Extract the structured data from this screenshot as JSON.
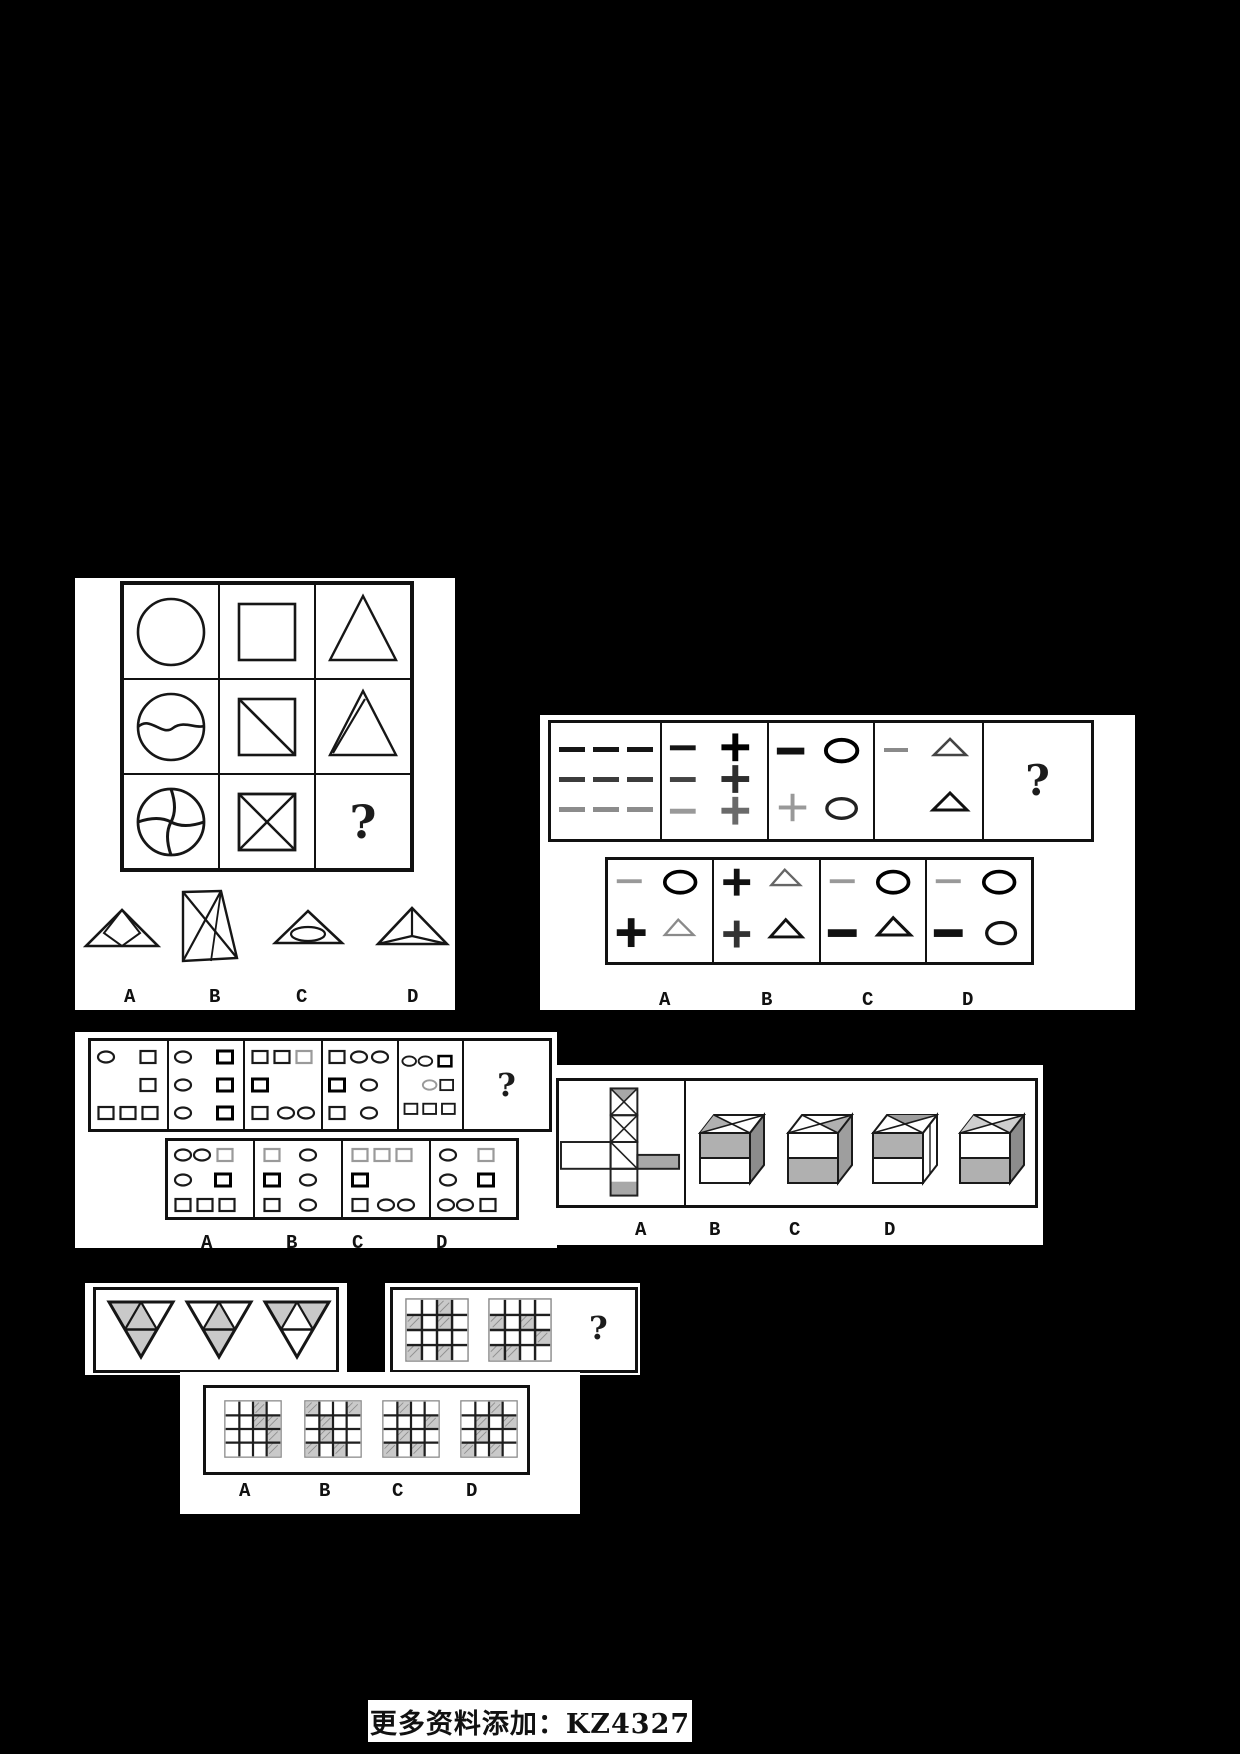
{
  "glyphs": {
    "question_mark": "?"
  },
  "footer": {
    "text": "更多资料添加：KZ4327"
  },
  "puzzle1": {
    "type": "figure-matrix-3x3",
    "matrix": [
      [
        "circle",
        "square",
        "triangle"
      ],
      [
        "circle-with-wave-line",
        "square-with-diagonal",
        "triangle-with-inner-line"
      ],
      [
        "circle-pinwheel",
        "square-with-x",
        "?"
      ]
    ],
    "options": [
      {
        "label": "A",
        "figure": "triangle-with-inscribed-diamond"
      },
      {
        "label": "B",
        "figure": "tall-quadrilateral-with-crossed-diagonals"
      },
      {
        "label": "C",
        "figure": "triangle-with-inscribed-ellipse"
      },
      {
        "label": "D",
        "figure": "triangle-with-apex-lines-pyramid"
      }
    ]
  },
  "puzzle2": {
    "type": "figure-sequence",
    "cells": [
      "nine-dashes-3x3-fading",
      "three-dashes-left-three-plusses-right",
      "dash-oval-top-plus-oval-bottom",
      "dash-triangle-top-triangle-bottom",
      "?"
    ],
    "options": [
      {
        "label": "A",
        "figure": "dash-oval-top-plus-triangle-bottom"
      },
      {
        "label": "B",
        "figure": "plus-triangle-top-plus-triangle-bottom"
      },
      {
        "label": "C",
        "figure": "dash-oval-top-dash-triangle-bottom"
      },
      {
        "label": "D",
        "figure": "dash-oval-top-dash-oval-bottom"
      }
    ]
  },
  "puzzle3": {
    "type": "figure-sequence-small-shapes",
    "cells": [
      "oval-square / square / three-squares",
      "oval-square / oval-square / oval-square",
      "three-squares / square / square-two-ovals",
      "square-two-ovals / square-oval / square-oval",
      "two-ovals-square / oval-square / three-squares",
      "?"
    ],
    "options": [
      {
        "label": "A",
        "figure": "two-ovals-square / oval-square / three-squares"
      },
      {
        "label": "B",
        "figure": "square-oval / square-oval / square-oval"
      },
      {
        "label": "C",
        "figure": "three-squares / square / square-two-ovals"
      },
      {
        "label": "D",
        "figure": "oval-square / oval-square / two-ovals-square"
      }
    ]
  },
  "puzzle4": {
    "type": "cube-net-folding",
    "net": "vertical-strip-of-4-squares-with-x-diagonal-and-gray-faces-plus-side-rectangles",
    "options": [
      {
        "label": "A",
        "figure": "cube-gray-top-front-dark-right"
      },
      {
        "label": "B",
        "figure": "cube-white-top-front-gray-bottom"
      },
      {
        "label": "C",
        "figure": "cube-gray-top-front-white-right"
      },
      {
        "label": "D",
        "figure": "cube-white-top-front-gray-bottom-dark-right"
      }
    ]
  },
  "puzzle5": {
    "type": "shaded-triangles-and-grids",
    "triangles": [
      {
        "shaded": [
          "left",
          "center",
          "bottom"
        ]
      },
      {
        "shaded": [
          "center",
          "bottom"
        ]
      },
      {
        "shaded": [
          "left",
          "right"
        ]
      }
    ],
    "question_grids": [
      {
        "shaded": [
          [
            0,
            2
          ],
          [
            1,
            0
          ],
          [
            1,
            2
          ],
          [
            3,
            0
          ],
          [
            3,
            2
          ]
        ]
      },
      {
        "shaded": [
          [
            1,
            0
          ],
          [
            1,
            2
          ],
          [
            2,
            3
          ],
          [
            3,
            0
          ],
          [
            3,
            1
          ]
        ]
      }
    ],
    "option_grids": [
      {
        "label": "A",
        "shaded": [
          [
            0,
            2
          ],
          [
            1,
            2
          ],
          [
            1,
            3
          ],
          [
            2,
            3
          ],
          [
            3,
            3
          ]
        ]
      },
      {
        "label": "B",
        "shaded": [
          [
            0,
            0
          ],
          [
            0,
            3
          ],
          [
            1,
            1
          ],
          [
            2,
            1
          ],
          [
            3,
            0
          ],
          [
            3,
            2
          ]
        ]
      },
      {
        "label": "C",
        "shaded": [
          [
            0,
            1
          ],
          [
            1,
            3
          ],
          [
            2,
            1
          ],
          [
            3,
            0
          ],
          [
            3,
            2
          ]
        ]
      },
      {
        "label": "D",
        "shaded": [
          [
            0,
            2
          ],
          [
            1,
            1
          ],
          [
            1,
            3
          ],
          [
            2,
            1
          ],
          [
            3,
            0
          ],
          [
            3,
            2
          ]
        ]
      }
    ]
  }
}
